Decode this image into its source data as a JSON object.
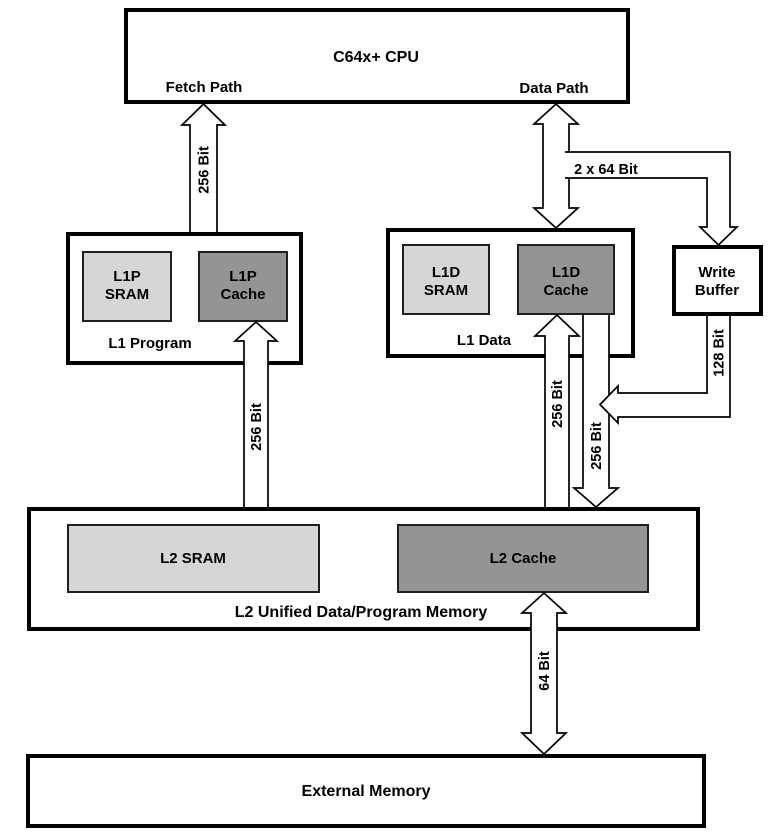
{
  "cpu": {
    "title": "C64x+ CPU",
    "fetch_path": "Fetch Path",
    "data_path": "Data Path"
  },
  "l1_program": {
    "label": "L1 Program",
    "sram": {
      "line1": "L1P",
      "line2": "SRAM"
    },
    "cache": {
      "line1": "L1P",
      "line2": "Cache"
    }
  },
  "l1_data": {
    "label": "L1 Data",
    "sram": {
      "line1": "L1D",
      "line2": "SRAM"
    },
    "cache": {
      "line1": "L1D",
      "line2": "Cache"
    }
  },
  "write_buffer": {
    "line1": "Write",
    "line2": "Buffer"
  },
  "l2": {
    "label": "L2 Unified Data/Program Memory",
    "sram_label": "L2 SRAM",
    "cache_label": "L2 Cache"
  },
  "external_memory": {
    "label": "External Memory"
  },
  "buses": {
    "cpu_fetch": "256 Bit",
    "cpu_data": "2 x 64 Bit",
    "l2_to_l1p": "256 Bit",
    "l2_to_l1d": "256 Bit",
    "l1d_to_l2": "256 Bit",
    "write_buffer_to_l2": "128 Bit",
    "l2_to_external": "64 Bit"
  },
  "colors": {
    "background": "#ffffff",
    "box_fill": "#ffffff",
    "outline": "#000000",
    "sram_fill": "#d6d6d6",
    "cache_fill": "#949494",
    "external_fill": "#cfcfcf"
  }
}
